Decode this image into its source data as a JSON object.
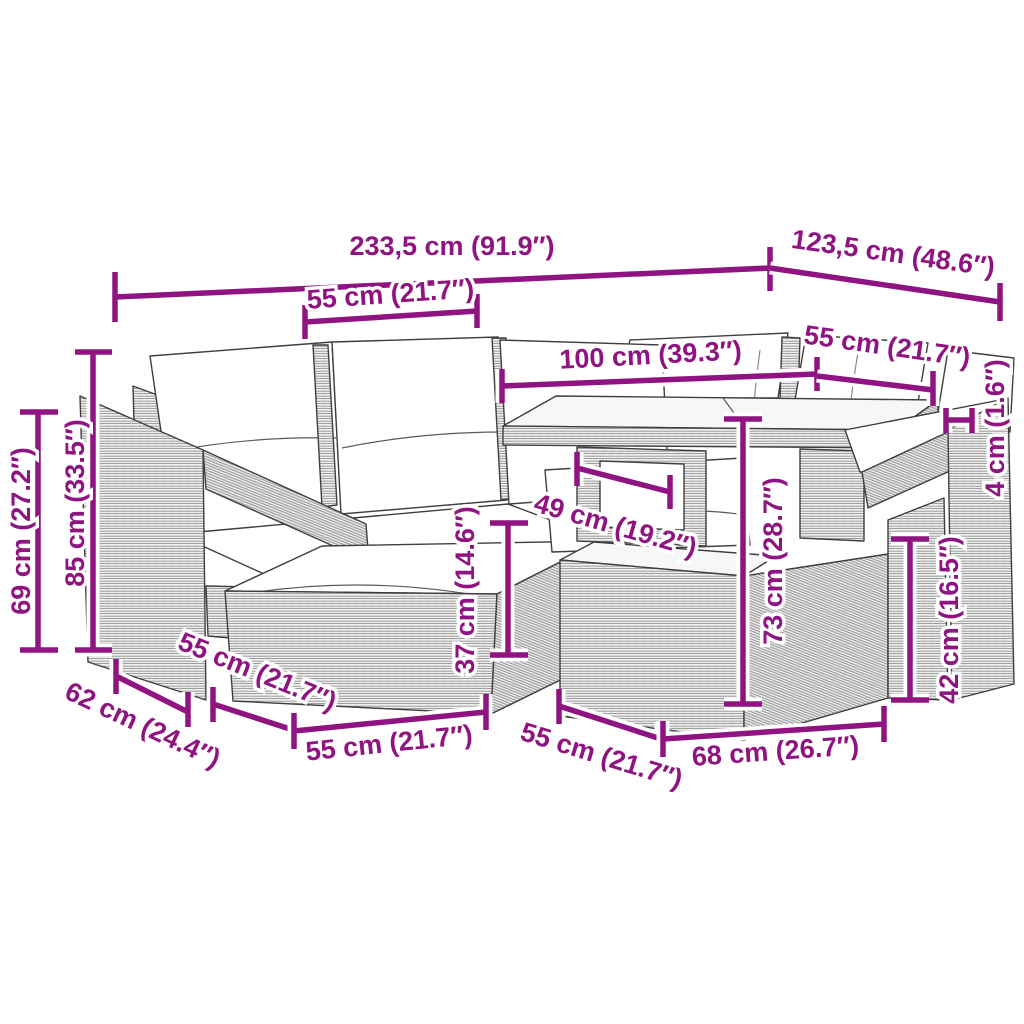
{
  "page": {
    "type": "product dimension diagram",
    "illustration": "grey poly-rattan garden lounge set: corner sofa with white cushions, two ottoman stools, storage chest and glass-top table"
  },
  "colors": {
    "dimension_annotation": "#8F1380",
    "line_art": "#3F3F3F",
    "cushion_fill": "#FFFFFF",
    "rattan_fill": "#F1F1F1",
    "background": "#FFFFFF"
  },
  "dims": [
    {
      "id": "overall-width",
      "label": "233,5 cm (91.9″)"
    },
    {
      "id": "overall-depth",
      "label": "123,5 cm (48.6″)"
    },
    {
      "id": "seat-width",
      "label": "55 cm (21.7″)"
    },
    {
      "id": "table-length",
      "label": "100 cm (39.3″)"
    },
    {
      "id": "right-seat-width",
      "label": "55 cm (21.7″)"
    },
    {
      "id": "tabletop-thickness",
      "label": "4 cm (1.6″)"
    },
    {
      "id": "arm-height",
      "label": "69 cm (27.2″)"
    },
    {
      "id": "back-height",
      "label": "85 cm (33.5″)"
    },
    {
      "id": "table-clearance",
      "label": "49 cm (19.2″)"
    },
    {
      "id": "ottoman-height",
      "label": "37 cm (14.6″)"
    },
    {
      "id": "table-height",
      "label": "73 cm (28.7″)"
    },
    {
      "id": "chest-height",
      "label": "42 cm (16.5″)"
    },
    {
      "id": "sofa-depth",
      "label": "62 cm (24.4″)"
    },
    {
      "id": "ottoman-depth",
      "label": "55 cm (21.7″)"
    },
    {
      "id": "ottoman-width",
      "label": "55 cm (21.7″)"
    },
    {
      "id": "chest-depth",
      "label": "55 cm (21.7″)"
    },
    {
      "id": "chest-width",
      "label": "68 cm (26.7″)"
    }
  ]
}
